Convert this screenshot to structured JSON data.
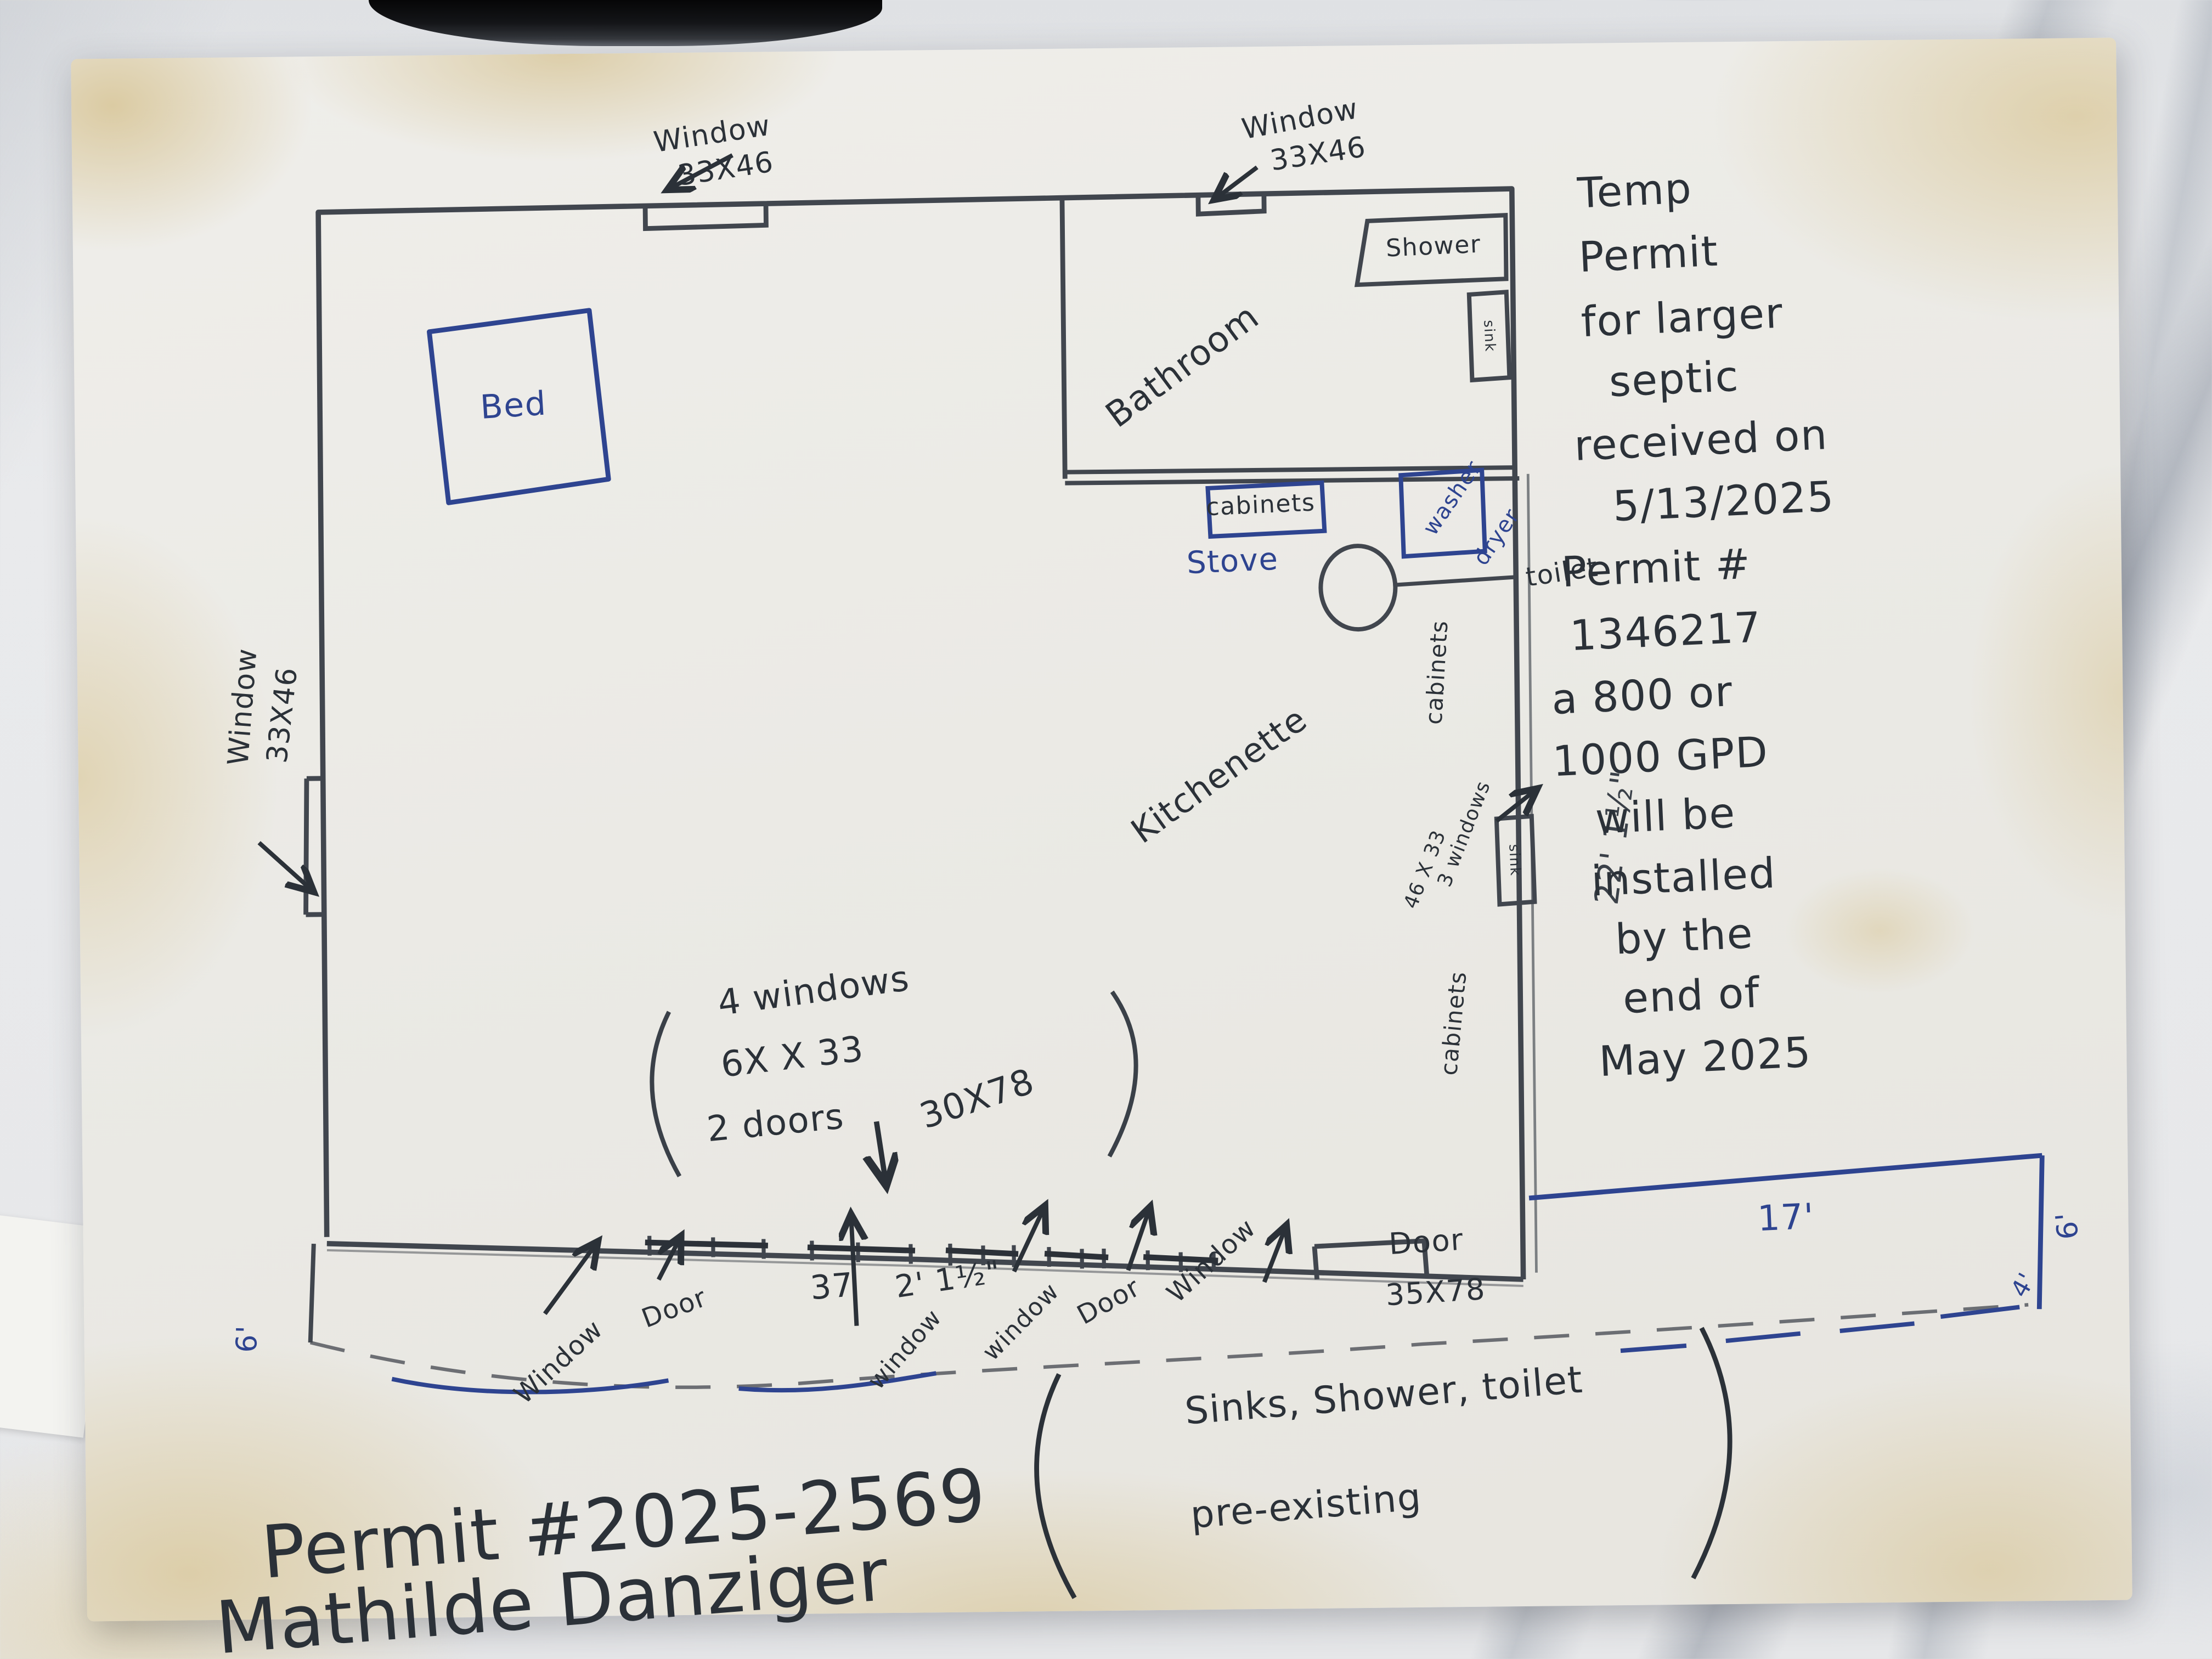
{
  "colors": {
    "pencil": "#41464e",
    "ink": "#2b3138",
    "blue": "#2e4490"
  },
  "labels": {
    "window_top_left": {
      "l1": "Window",
      "l2": "33X46"
    },
    "window_top_right": {
      "l1": "Window",
      "l2": "33X46"
    },
    "window_left": {
      "l1": "Window",
      "l2": "33X46"
    },
    "bed": "Bed",
    "bathroom": "Bathroom",
    "shower": "Shower",
    "bath_sink": "sink",
    "toilet": "toilet",
    "cabinets_top": "cabinets",
    "stove": "Stove",
    "washer": "washer",
    "dryer": "dryer",
    "cabinets_right_upper": "cabinets",
    "cabinets_right_lower": "cabinets",
    "kitchenette": "Kitchenette",
    "kitchen_sink": "sink",
    "three_windows": {
      "l1": "3 windows",
      "l2": "46 X 33"
    },
    "dim_right_wall": "22' 1½\"",
    "center_note": {
      "l1": "4 windows",
      "l2": "6X X 33",
      "l3": "2 doors",
      "l4": "30X78"
    },
    "bottom_row": {
      "window1": "Window",
      "door1": "Door",
      "dim37": "37",
      "dim21": "2' 1½\"",
      "window2": "window",
      "window3": "window",
      "door2": "Door",
      "window4": "Window",
      "door3": "Door",
      "door3_size": "35X78",
      "dim17": "17'",
      "dim6_left": "6'",
      "dim6_right": "6'",
      "dim4_right": "4'"
    },
    "pre_existing": {
      "l1": "Sinks, Shower, toilet",
      "l2": "pre-existing"
    },
    "septic": [
      "Temp",
      "Permit",
      "for larger",
      "septic",
      "received on",
      "5/13/2025"
    ],
    "gpd": [
      "Permit #",
      "1346217",
      "a 800 or",
      "1000 GPD",
      "will be",
      "installed",
      "by the",
      "end of",
      "May 2025"
    ],
    "footer": {
      "l1": "Permit #2025-2569",
      "l2": "Mathilde Danziger"
    }
  }
}
